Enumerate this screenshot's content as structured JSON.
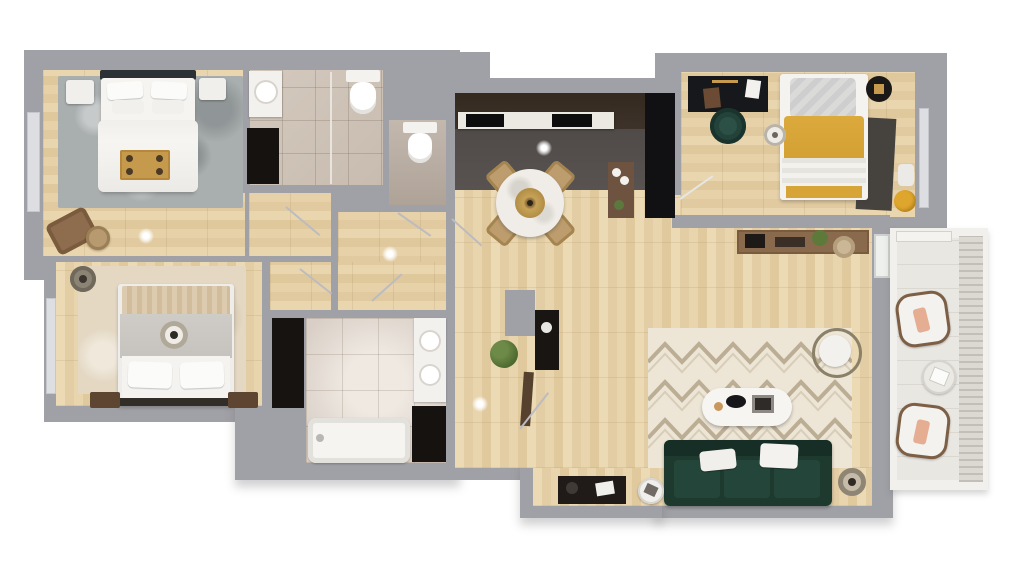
{
  "scene": {
    "kind": "3D rendered apartment floor plan, top-down view",
    "no_visible_text": true,
    "background": "#ffffff"
  },
  "palette": {
    "bg": "#ffffff",
    "wall": "#a0a1a6",
    "wood": "#e5d0a8",
    "tileBeige": "#cfc4b9",
    "tileLight": "#ddd3ca",
    "kitchenFloor": "#514c4a",
    "kitchenCabinet": "#382e27",
    "applianceBlack": "#121114",
    "linenWhite": "#f4f3f0",
    "rugGray": "#a9aeae",
    "rugBeige": "#e4d8c3",
    "chevronRugBase": "#ede5d5",
    "chevronRugLine": "#b4a58b",
    "sofaGreen": "#1e3a2f",
    "chairGreen": "#23433a",
    "mustard": "#d6a437",
    "gold": "#c79a4e",
    "woodFurniture": "#8a6a4c",
    "darkWood": "#5d4531",
    "plantGreen": "#5c783c",
    "balconyFloor": "#e9e7e2",
    "peach": "#e5ae92"
  },
  "rooms": {
    "bedroom1": {
      "label": "Bedroom 1 (top left)",
      "floor": "wood"
    },
    "bathroom1": {
      "label": "Bathroom 1 with shower",
      "floor": "beige tile"
    },
    "wc": {
      "label": "Guest WC",
      "floor": "stone"
    },
    "bedroom2": {
      "label": "Bedroom 2 (bottom left)",
      "floor": "wood"
    },
    "bathroom2": {
      "label": "Main bathroom with bathtub",
      "floor": "light tile"
    },
    "hallway": {
      "label": "Hallway",
      "floor": "wood"
    },
    "kitchen": {
      "label": "Kitchen",
      "floor": "dark stone"
    },
    "dining": {
      "label": "Dining area",
      "floor": "wood"
    },
    "bedroom3": {
      "label": "Bedroom 3 / office (top right)",
      "floor": "wood"
    },
    "living": {
      "label": "Living room",
      "floor": "wood"
    },
    "entry": {
      "label": "Entry",
      "floor": "wood"
    },
    "balcony": {
      "label": "Balcony with railing",
      "floor": "light tile"
    }
  },
  "furniture": {
    "bed1": {
      "room": "bedroom1",
      "name": "Double bed, white duvet, gold breakfast tray",
      "color": "#f4f3f0"
    },
    "rug1": {
      "room": "bedroom1",
      "name": "Gray textured area rug",
      "color": "#a9aeae"
    },
    "loungeChair1": {
      "room": "bedroom1",
      "name": "Brown lounge chair with round side table",
      "color": "#8d6d4d"
    },
    "vanity1": {
      "room": "bathroom1",
      "name": "Washbasin vanity",
      "color": "#f2f1ee"
    },
    "toilet1": {
      "room": "bathroom1",
      "name": "Toilet",
      "color": "#f5f4f1"
    },
    "toilet2": {
      "room": "wc",
      "name": "Toilet",
      "color": "#f5f4f1"
    },
    "bed2": {
      "room": "bedroom2",
      "name": "Double bed, gray duvet and textured throw",
      "color": "#ccc9c4"
    },
    "wardrobe2": {
      "room": "bedroom2",
      "name": "Dark wardrobe",
      "color": "#161310"
    },
    "bathtub": {
      "room": "bathroom2",
      "name": "Bathtub",
      "color": "#f5f4f1"
    },
    "vanity2": {
      "room": "bathroom2",
      "name": "Double-sink vanity",
      "color": "#f2f1ee"
    },
    "island": {
      "room": "kitchen",
      "name": "Marble counter with cooktop and sink",
      "color": "#ece9e3"
    },
    "fridge": {
      "room": "kitchen",
      "name": "Tall black appliance column",
      "color": "#121114"
    },
    "diningTable": {
      "room": "dining",
      "name": "Round marble dining table, 4 wooden chairs, gold pendant",
      "color": "#efece7"
    },
    "desk3": {
      "room": "bedroom3",
      "name": "Black desk with green office chair",
      "color": "#17181b"
    },
    "bed3": {
      "room": "bedroom3",
      "name": "Bed with mustard blanket",
      "color": "#d6a437"
    },
    "pouf3": {
      "room": "bedroom3",
      "name": "Yellow pouf",
      "color": "#dfa62e"
    },
    "consoleHall": {
      "room": "hallway",
      "name": "Wooden console with plant and basket",
      "color": "#8a6a4c"
    },
    "sofa": {
      "room": "living",
      "name": "Dark green 3-seat sofa with white cushions",
      "color": "#1e3a2f"
    },
    "chevronRug": {
      "room": "living",
      "name": "Cream chevron rug",
      "color": "#ede5d5"
    },
    "coffeeTable": {
      "room": "living",
      "name": "White oval coffee table",
      "color": "#f6f5f2"
    },
    "armchair": {
      "room": "living",
      "name": "Round lounge armchair",
      "color": "#f3f1ed"
    },
    "floorLamp": {
      "room": "living",
      "name": "Floor lamp",
      "color": "#8f8574"
    },
    "mediaUnit": {
      "room": "living",
      "name": "Dark media console",
      "color": "#201b18"
    },
    "balconyChairs": {
      "room": "balcony",
      "name": "Two lounge chairs with peach cushions and side table",
      "color": "#f4f2ee"
    }
  }
}
